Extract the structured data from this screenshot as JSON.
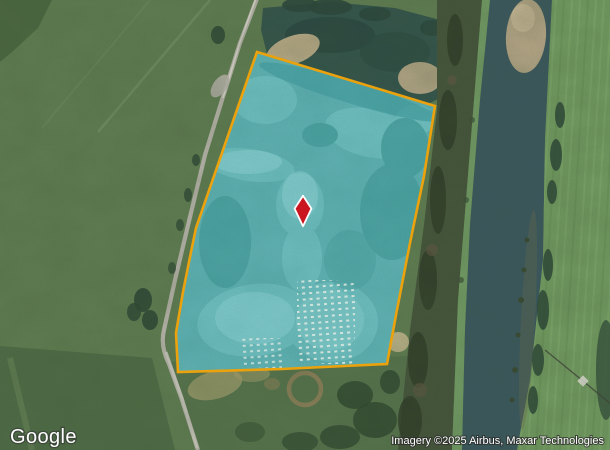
{
  "map": {
    "logo_text": "Google",
    "attribution_text": "Imagery ©2025 Airbus, Maxar Technologies"
  },
  "parcel": {
    "border_color": "#f3a60b",
    "overlay_color": "#18a7b2"
  },
  "marker": {
    "fill_color": "#c9161f",
    "outline_color": "#ffffff"
  }
}
